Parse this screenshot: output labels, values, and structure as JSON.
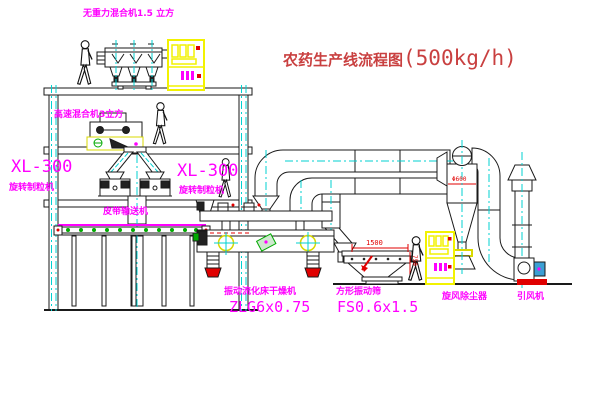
{
  "title": {
    "text_cn": "农药生产线流程图",
    "capacity": "(500kg/h)"
  },
  "labels": {
    "top_mixer": "无重力混合机1.5 立方",
    "floor2_mixer": "高速混合机3立方",
    "granulator_left": {
      "model": "XL-300",
      "name": "旋转制粒机"
    },
    "granulator_center": {
      "model": "XL-300",
      "name": "旋转制粒机"
    },
    "belt_conveyor": "皮带输送机",
    "dryer": {
      "name": "振动流化床干燥机",
      "model": "ZLG6x0.75"
    },
    "sieve": {
      "name": "方形振动筛",
      "model": "FS0.6x1.5"
    },
    "cyclone": "旋风除尘器",
    "fan": "引风机"
  },
  "dimensions": {
    "sieve_width": "1500",
    "sieve_height": "750",
    "cyclone_diameter": "Φ600"
  },
  "colors": {
    "label_magenta": "#ff00ff",
    "title_red": "#c94040",
    "centerline_cyan": "#00d2d2",
    "cabinet_yellow": "#f2f200",
    "dimension_red": "#e00000",
    "roller_green": "#00aa00",
    "line_black": "#1a1a1a"
  }
}
